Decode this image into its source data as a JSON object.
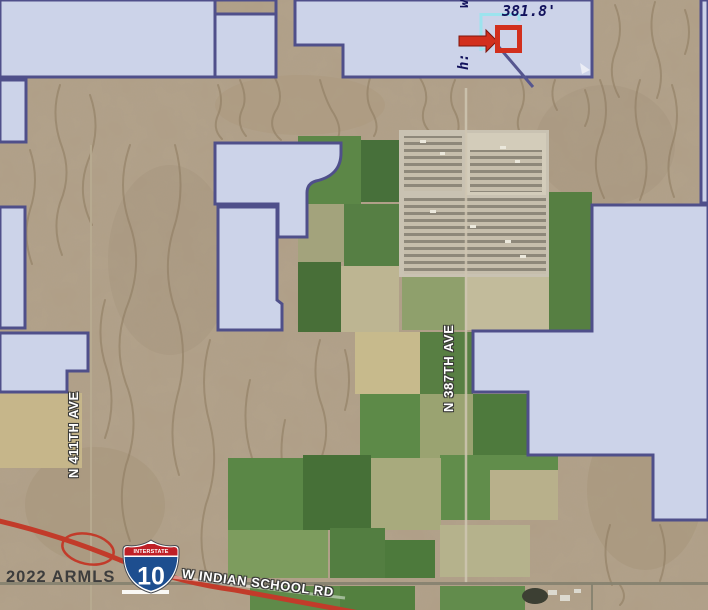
{
  "attribution": {
    "text": "2022 ARMLS"
  },
  "roads": {
    "n_411th_ave": "N 411TH AVE",
    "n_387th_ave": "N 387TH AVE",
    "w_indian_school_rd": "W INDIAN SCHOOL RD"
  },
  "highway_shield": {
    "banner": "INTERSTATE",
    "number": "10"
  },
  "measurement": {
    "width_label": "w:",
    "height_label": "h:",
    "value": "381.8'"
  },
  "colors": {
    "desert": "#b3a28c",
    "parcel_fill": "#ccd3e9",
    "parcel_border": "#4f4f8a",
    "highway_red": "#c23b2a",
    "marker_red": "#d22f1d",
    "measure_cyan": "#9ae4ef",
    "measure_text": "#12125c",
    "shield_blue": "#1d4e8f",
    "shield_red": "#bf2026",
    "field_green": "#5c8747"
  }
}
